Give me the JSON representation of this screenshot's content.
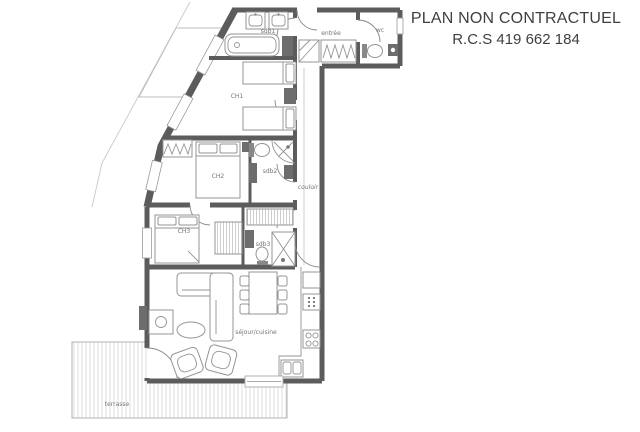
{
  "header": {
    "line1": "PLAN NON CONTRACTUEL",
    "line2": "R.C.S 419 662 184"
  },
  "plan": {
    "rooms": [
      {
        "id": "sdb1",
        "label": "sdb1"
      },
      {
        "id": "entree",
        "label": "entrée"
      },
      {
        "id": "wc",
        "label": "wc"
      },
      {
        "id": "ch1",
        "label": "CH1"
      },
      {
        "id": "ch2",
        "label": "CH2"
      },
      {
        "id": "sdb2",
        "label": "sdb2"
      },
      {
        "id": "couloir",
        "label": "couloir"
      },
      {
        "id": "ch3",
        "label": "CH3"
      },
      {
        "id": "sdb3",
        "label": "sdb3"
      },
      {
        "id": "sejour",
        "label": "séjour/cuisine"
      },
      {
        "id": "terrasse",
        "label": "terrasse"
      }
    ],
    "colors": {
      "wall": "#5c5c5c",
      "furniture_line": "#949494",
      "furniture_dark": "#6d6d6d",
      "label_text": "#757575",
      "title_text": "#3f3f3f",
      "terrace_stripe": "#dedede",
      "background": "#ffffff"
    }
  }
}
